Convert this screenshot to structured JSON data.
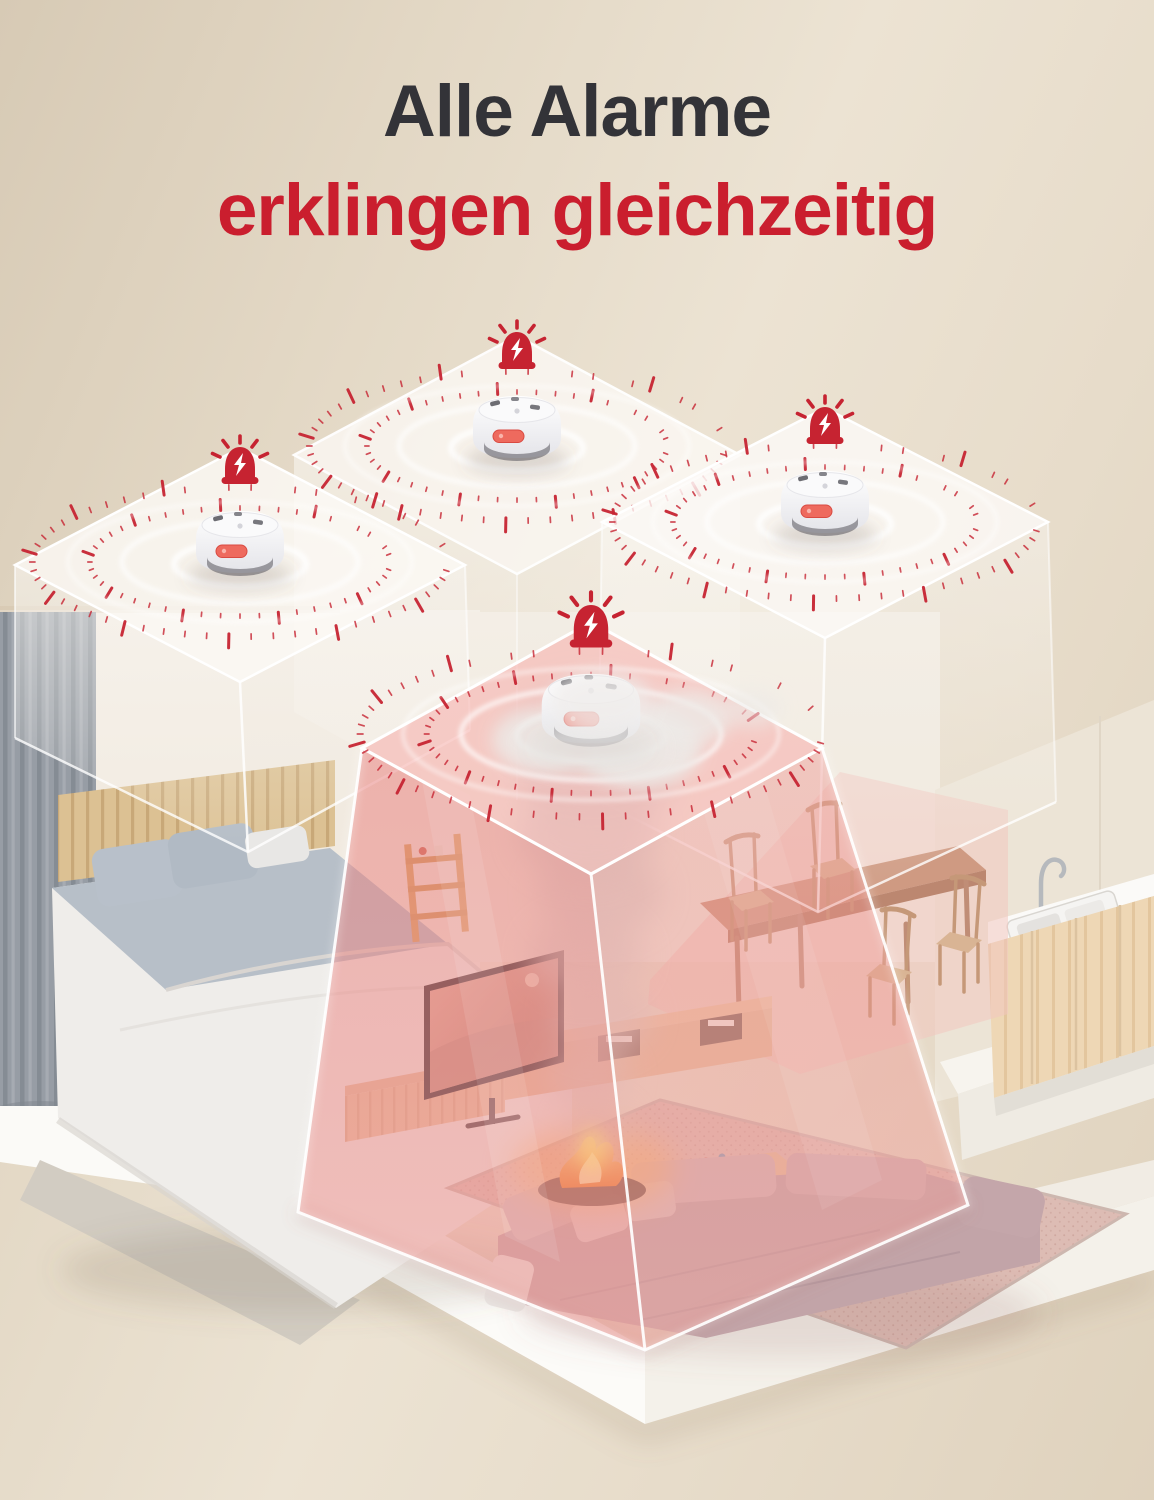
{
  "page": {
    "language": "de",
    "kind": "product-marketing-banner"
  },
  "heading": {
    "line1": "Alle Alarme",
    "line2": "erklingen gleichzeitig"
  },
  "colors": {
    "heading_text": "#333338",
    "accent_red": "#ca1e2e",
    "background_beige": "#e6dbc9",
    "alert_pink_overlay": "#ef9c98",
    "room_box_white": "#ffffff",
    "tick_red": "#c72533",
    "fire_orange": "#f59b35",
    "smoke_gray": "#d8d0cc"
  },
  "scene": {
    "rooms_visible": [
      "bedroom",
      "living-room",
      "dining-area",
      "kitchen"
    ],
    "alert_room": "living-room",
    "hazard": "fire-with-smoke",
    "detector_count": 4,
    "detectors": [
      {
        "id": "detector-back",
        "location": "back-room",
        "state": "alarming"
      },
      {
        "id": "detector-bedroom",
        "location": "bedroom",
        "state": "alarming"
      },
      {
        "id": "detector-dining",
        "location": "dining-area",
        "state": "alarming"
      },
      {
        "id": "detector-living",
        "location": "living-room",
        "state": "alarming"
      }
    ]
  }
}
